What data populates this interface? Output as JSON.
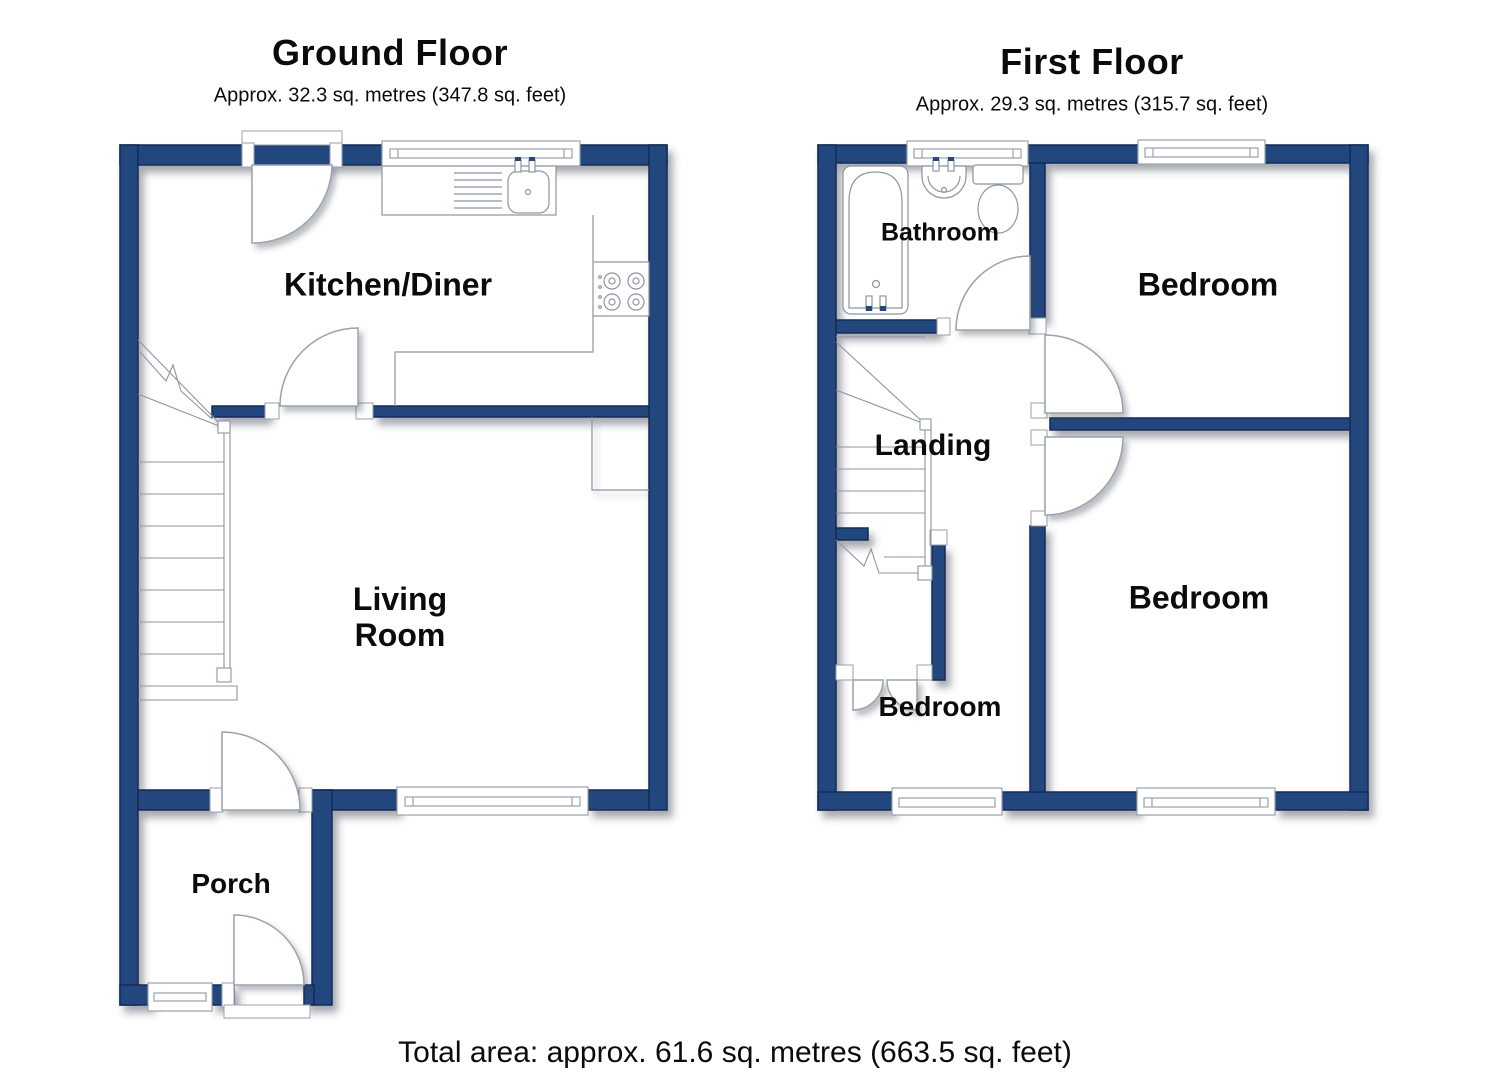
{
  "document_type": "floorplan",
  "colors": {
    "wall_fill": "#24477e",
    "wall_outline": "#122a52",
    "fixture_line": "#8d95a0",
    "text": "#0b0b0b",
    "background": "#ffffff"
  },
  "ground_floor": {
    "title": "Ground Floor",
    "area": "Approx. 32.3 sq. metres (347.8 sq. feet)",
    "rooms": {
      "kitchen_diner": "Kitchen/Diner",
      "living_room": "Living Room",
      "porch": "Porch"
    },
    "fixtures": [
      "kitchen-sink-drainer",
      "hob",
      "worktop",
      "stairs",
      "built-in-cupboard",
      "windows",
      "doors"
    ]
  },
  "first_floor": {
    "title": "First Floor",
    "area": "Approx. 29.3 sq. metres (315.7 sq. feet)",
    "rooms": {
      "bathroom": "Bathroom",
      "bedroom_right": "Bedroom",
      "landing": "Landing",
      "bedroom_bottom_left": "Bedroom",
      "bedroom_bottom_right": "Bedroom"
    },
    "fixtures": [
      "bathtub",
      "basin",
      "toilet",
      "stairs",
      "cupboard-double-doors",
      "windows",
      "doors"
    ]
  },
  "total_area": "Total area: approx. 61.6 sq. metres (663.5 sq. feet)"
}
